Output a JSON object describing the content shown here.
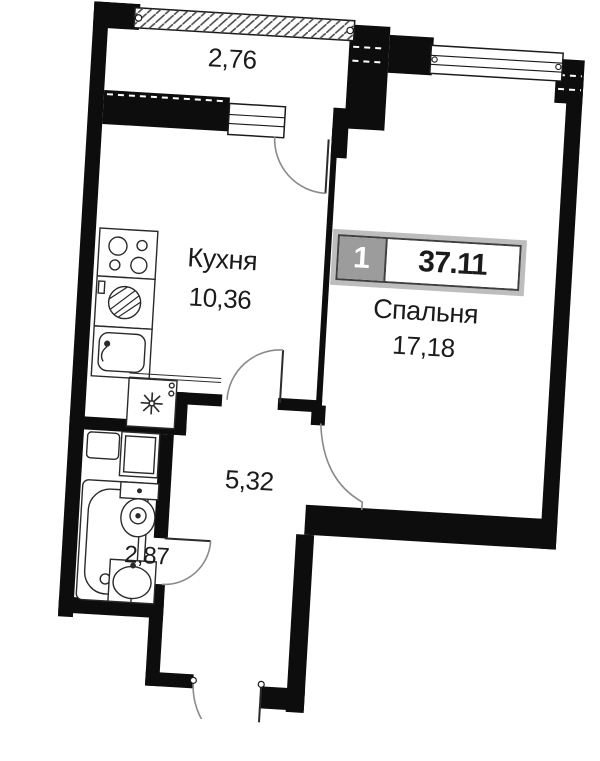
{
  "title": "Floor plan — 1-room apartment",
  "badge": {
    "rooms_count": "1",
    "total_area": "37.11"
  },
  "rooms": {
    "balcony": {
      "area": "2,76"
    },
    "kitchen": {
      "name": "Кухня",
      "area": "10,36"
    },
    "bedroom": {
      "name": "Спальня",
      "area": "17,18"
    },
    "hallway": {
      "area": "5,32"
    },
    "bathroom": {
      "area": "2,87"
    }
  },
  "colors": {
    "wall": "#0d0d0d",
    "door_arc": "#8a8a8a",
    "badge_gray": "#9c9c9c",
    "badge_border": "#3f3f3f",
    "text": "#1b1b1b"
  },
  "fixtures": [
    "stove-icon",
    "washing-machine-icon",
    "kitchen-sink-icon",
    "fridge-icon",
    "bathtub-icon",
    "toilet-icon",
    "washbasin-icon",
    "shelf-icon",
    "cabinet-icon",
    "window-icon",
    "glazing-icon",
    "door-arc-icon"
  ]
}
